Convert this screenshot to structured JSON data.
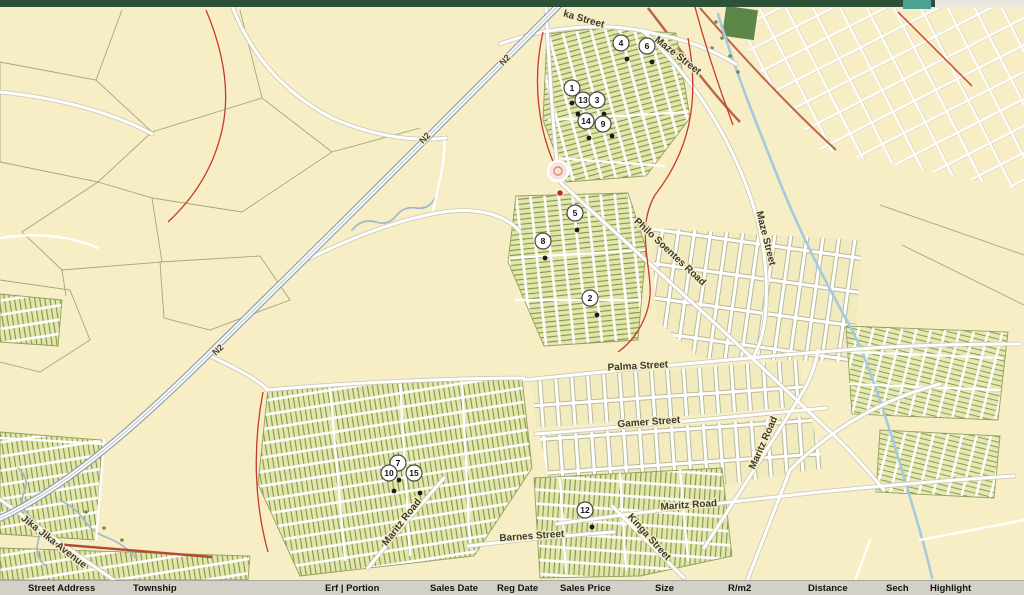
{
  "window": {
    "top_bar_color": "#2d5136",
    "top_bar_accent_color": "#4aa392",
    "map_background_color": "#f8eec6"
  },
  "map": {
    "highway_label": "N2",
    "street_labels": [
      {
        "text": "ka Street"
      },
      {
        "text": "Maze Street"
      },
      {
        "text": "Maze Street"
      },
      {
        "text": "Philo Soentes Road"
      },
      {
        "text": "Palma Street"
      },
      {
        "text": "Gamer Street"
      },
      {
        "text": "Maritz Road"
      },
      {
        "text": "Maritz Road"
      },
      {
        "text": "Maritz Road"
      },
      {
        "text": "Barnes Street"
      },
      {
        "text": "Kinga Street"
      },
      {
        "text": "Jika Jika Avenue"
      }
    ],
    "markers": [
      {
        "label": "4"
      },
      {
        "label": "6"
      },
      {
        "label": "1"
      },
      {
        "label": "13"
      },
      {
        "label": "3"
      },
      {
        "label": "14"
      },
      {
        "label": "9"
      },
      {
        "label": "5"
      },
      {
        "label": "8"
      },
      {
        "label": "2"
      },
      {
        "label": "7"
      },
      {
        "label": "10"
      },
      {
        "label": "15"
      },
      {
        "label": "12"
      }
    ],
    "subject_marker": {
      "dot_color": "#c62323"
    }
  },
  "table": {
    "columns": [
      "Street Address",
      "Township",
      "Erf | Portion",
      "Sales Date",
      "Reg Date",
      "Sales Price",
      "Size",
      "R/m2",
      "Distance",
      "Sech",
      "Highlight"
    ]
  }
}
